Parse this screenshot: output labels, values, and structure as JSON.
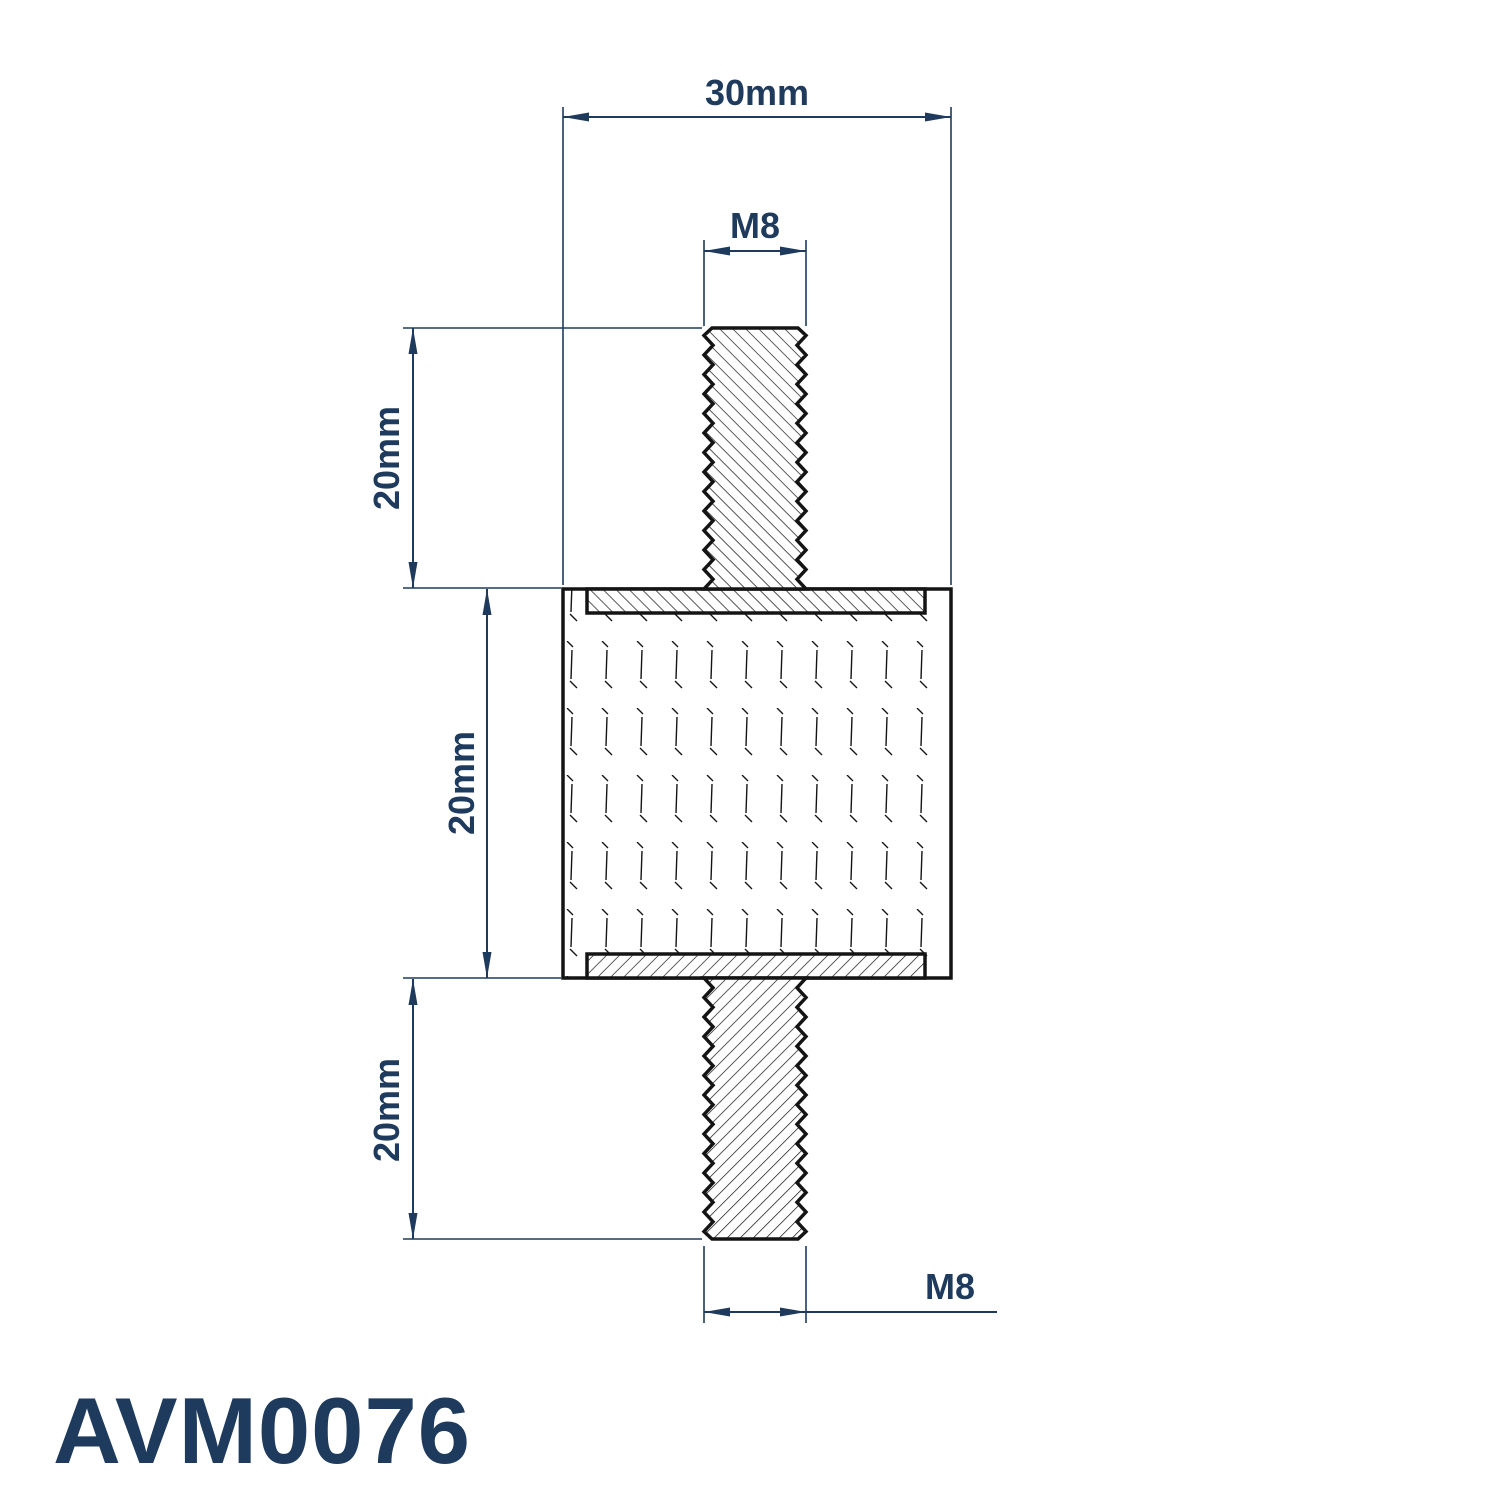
{
  "part_number": "AVM0076",
  "dimensions": {
    "overall_width": "30mm",
    "top_thread": "M8",
    "top_stud_length": "20mm",
    "body_height": "20mm",
    "bottom_stud_length": "20mm",
    "bottom_thread": "M8"
  },
  "colors": {
    "dimension": "#1e3a5c",
    "outline": "#141414",
    "background": "#ffffff"
  }
}
